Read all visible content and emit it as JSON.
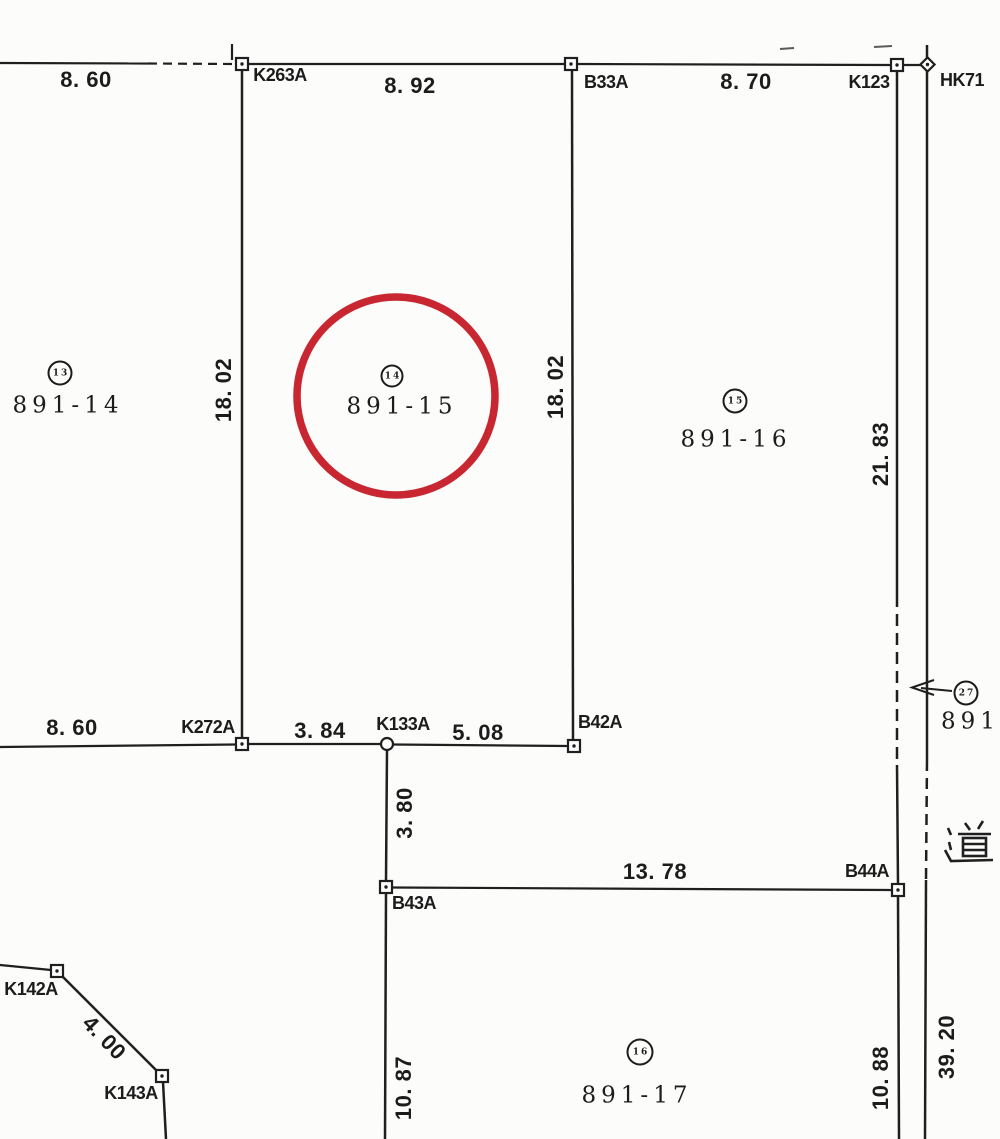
{
  "map_type": "cadastral-parcel-map",
  "road_label": "道",
  "colors": {
    "ink": "#1f1f1f",
    "highlight_red": "#c82630",
    "paper": "#fcfcfb"
  },
  "parcels": {
    "p891_14": {
      "label": "891-14",
      "point_no": "13"
    },
    "p891_15": {
      "label": "891-15",
      "point_no": "14",
      "highlighted": "red-circle"
    },
    "p891_16": {
      "label": "891-16",
      "point_no": "15"
    },
    "p891_17": {
      "label": "891-17",
      "point_no": "16"
    },
    "p891_27": {
      "label": "891-",
      "point_no": "27"
    }
  },
  "survey_points": {
    "k263a": "K263A",
    "b33a": "B33A",
    "k123": "K123",
    "hk71": "HK71",
    "k272a": "K272A",
    "k133a": "K133A",
    "b42a": "B42A",
    "b43a": "B43A",
    "b44a": "B44A",
    "k142a": "K142A",
    "k143a": "K143A"
  },
  "measurements": {
    "top_left": "8. 60",
    "top_mid": "8. 92",
    "top_right": "8. 70",
    "left_18_02": "18. 02",
    "mid_18_02": "18. 02",
    "right_21_83": "21. 83",
    "bottom_8_60": "8. 60",
    "seg_3_84": "3. 84",
    "seg_5_08": "5. 08",
    "stem_3_80": "3. 80",
    "seg_13_78": "13. 78",
    "diag_4_00": "4. 00",
    "low_10_87": "10. 87",
    "low_10_88": "10. 88",
    "road_39_20": "39. 20"
  }
}
